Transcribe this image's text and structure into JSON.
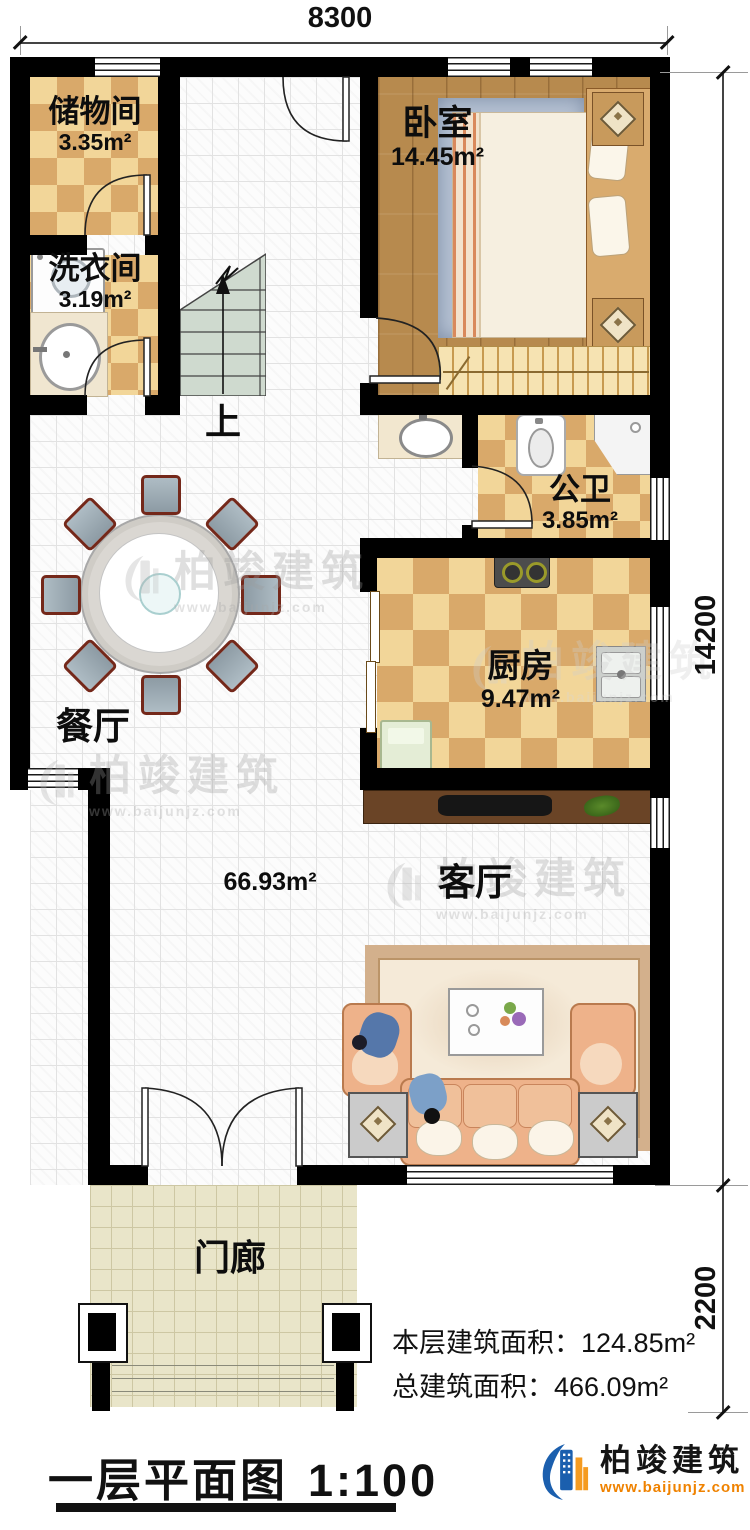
{
  "title": {
    "text": "一层平面图",
    "scale": "1:100"
  },
  "logo": {
    "name": "柏竣建筑",
    "url": "www.baijunjz.com"
  },
  "watermark": {
    "name": "柏竣建筑",
    "url": "www.baijunjz.com"
  },
  "stats": [
    {
      "label": "本层建筑面积：",
      "value": "124.85m²"
    },
    {
      "label": "总建筑面积：",
      "value": "466.09m²"
    }
  ],
  "dimensions": {
    "top": "8300",
    "right_main": "14200",
    "right_porch": "2200"
  },
  "rooms": {
    "storage": {
      "name": "储物间",
      "area": "3.35m²"
    },
    "laundry": {
      "name": "洗衣间",
      "area": "3.19m²"
    },
    "bedroom": {
      "name": "卧室",
      "area": "14.45m²"
    },
    "bathroom": {
      "name": "公卫",
      "area": "3.85m²"
    },
    "kitchen": {
      "name": "厨房",
      "area": "9.47m²"
    },
    "dining": {
      "name": "餐厅"
    },
    "living": {
      "name": "客厅"
    },
    "porch": {
      "name": "门廊"
    },
    "hall": {
      "area": "66.93m²"
    },
    "stairs": {
      "label": "上"
    }
  },
  "colors": {
    "wall": "#000000",
    "checker_light": "#f2d699",
    "checker_dark": "#d9a96a",
    "wood_floor": "#b78a4e",
    "stair": "#cfdacf",
    "porch": "#e9e5c9",
    "sofa": "#eeb28a",
    "tv_cabinet": "#6a4426",
    "logo_blue": "#1b5fae",
    "logo_orange": "#f59b20"
  }
}
